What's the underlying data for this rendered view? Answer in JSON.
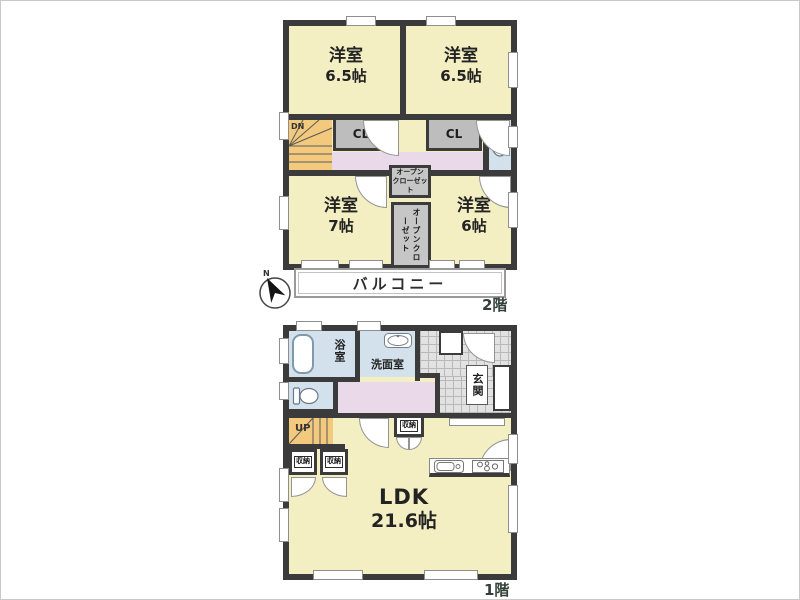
{
  "plan_type": "floorplan",
  "colors": {
    "wall": "#3b3b3b",
    "room_yellow": "#f3efc3",
    "stairs_orange": "#f2c97d",
    "closet_gray": "#bdbdbd",
    "hall_pink": "#ead9e8",
    "water_blue": "#d2e1eb",
    "tile_gray": "#e2e2e2"
  },
  "floor2": {
    "floor_label": "2階",
    "room_nw": {
      "name": "洋室",
      "size": "6.5帖"
    },
    "room_ne": {
      "name": "洋室",
      "size": "6.5帖"
    },
    "room_sw": {
      "name": "洋室",
      "size": "7帖"
    },
    "room_se": {
      "name": "洋室",
      "size": "6帖"
    },
    "closet_left": "CL",
    "closet_right": "CL",
    "stairs_down": "DN",
    "open_closet_upper": "オープン\nクローゼット",
    "open_closet_lower": "オープンクローゼット",
    "balcony": "バルコニー",
    "compass": "N"
  },
  "floor1": {
    "floor_label": "1階",
    "bath": "浴室",
    "washroom": "洗面室",
    "entrance": "玄関",
    "stairs_up": "UP",
    "storage_left": "収納",
    "storage_right": "収納",
    "storage_mid": "収納",
    "ldk": {
      "name": "LDK",
      "size": "21.6帖"
    }
  }
}
